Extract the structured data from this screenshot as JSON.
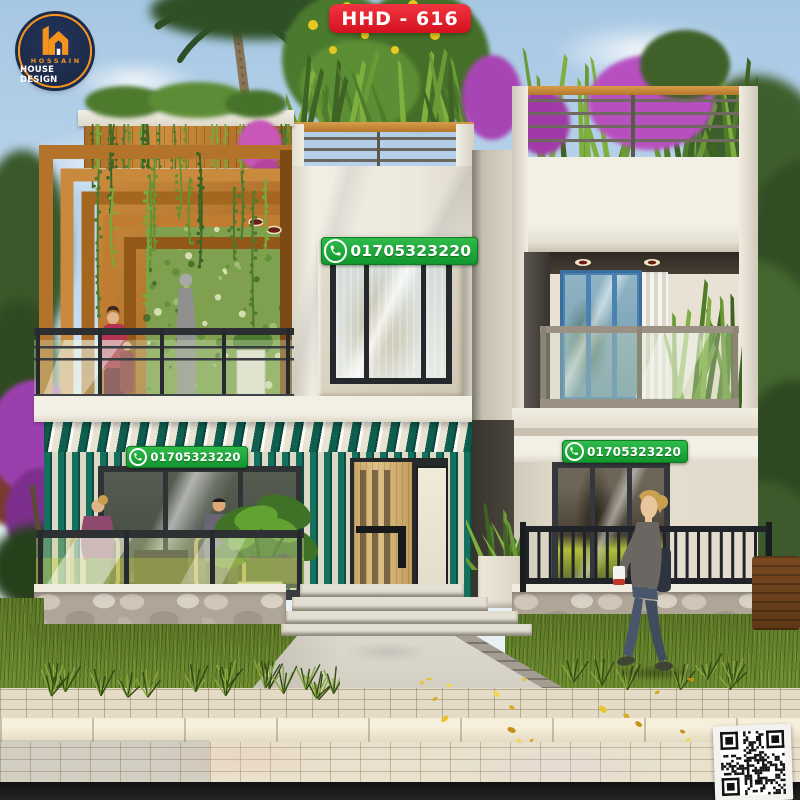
{
  "branding": {
    "logo": {
      "line1": "HOSSAIN",
      "line2": "HOUSE DESIGN",
      "icon": "house-h-monogram",
      "circle_color": "#1d2b4a",
      "accent_color": "#f6931d"
    },
    "model_badge": {
      "label": "HHD - 616",
      "bg_color": "#e8202d",
      "text_color": "#ffffff"
    }
  },
  "contact": {
    "whatsapp_number": "01705323220",
    "icon": "whatsapp-phone-icon",
    "badge_color": "#1ca93c",
    "placements": [
      "first-floor-window",
      "ground-terrace-left",
      "ground-window-right"
    ]
  },
  "qr_code": {
    "present": true,
    "label": "qr-code"
  },
  "scene": {
    "type": "3d-exterior-render",
    "subject": "modern two-storey duplex house with rooftop garden",
    "palette": {
      "sky": "#b5d1e8",
      "facade": "#edeade",
      "teal_slats": "#15705d",
      "wood": "#b5762c",
      "grass": "#63812b",
      "stone": "#b0a698",
      "pavement": "#e4dcc6",
      "window_frame_blue": "#4a82b4"
    }
  }
}
